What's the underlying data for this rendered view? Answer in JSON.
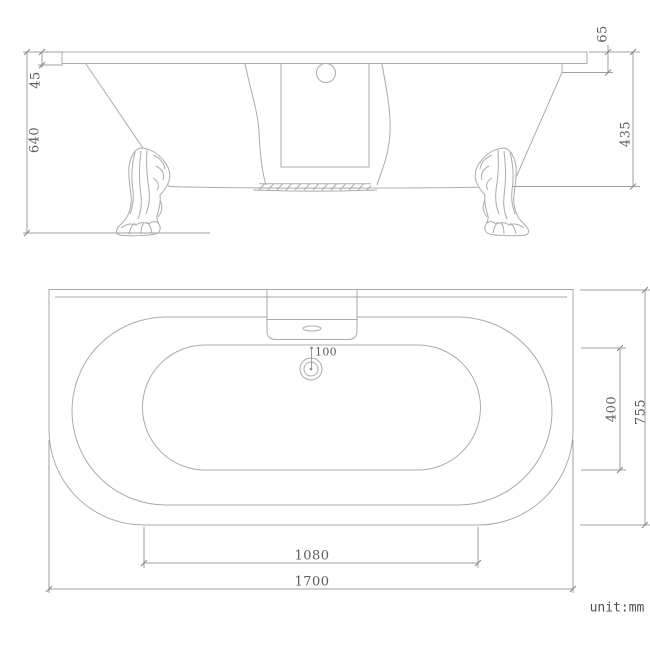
{
  "unit_label": "unit:mm",
  "side_view": {
    "dims": {
      "overall_height": "640",
      "rim_thickness": "45",
      "rim_to_shoulder": "65",
      "shoulder_to_base": "435"
    }
  },
  "plan_view": {
    "dims": {
      "drain_offset": "100",
      "inner_width": "400",
      "overall_width": "755",
      "floor_length": "1080",
      "overall_length": "1700"
    }
  }
}
